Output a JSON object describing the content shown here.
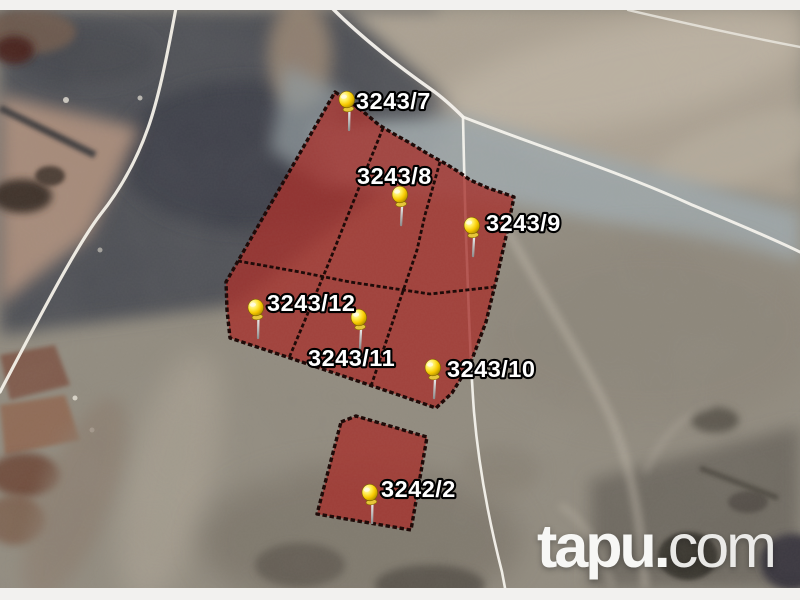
{
  "watermark": {
    "brand_bold": "tapu.",
    "brand_light": "com"
  },
  "parcels": [
    {
      "label": "3243/7"
    },
    {
      "label": "3243/8"
    },
    {
      "label": "3243/9"
    },
    {
      "label": "3243/12"
    },
    {
      "label": "3243/11"
    },
    {
      "label": "3243/10"
    },
    {
      "label": "3242/2"
    }
  ],
  "icons": {
    "marker": "yellow-pushpin"
  },
  "colors": {
    "parcel_fill": "#a5302a",
    "parcel_border": "#1a0604",
    "pin_yellow": "#ffd800",
    "road_line": "#f6f3ed",
    "frame_strip": "#f2f1ef"
  }
}
